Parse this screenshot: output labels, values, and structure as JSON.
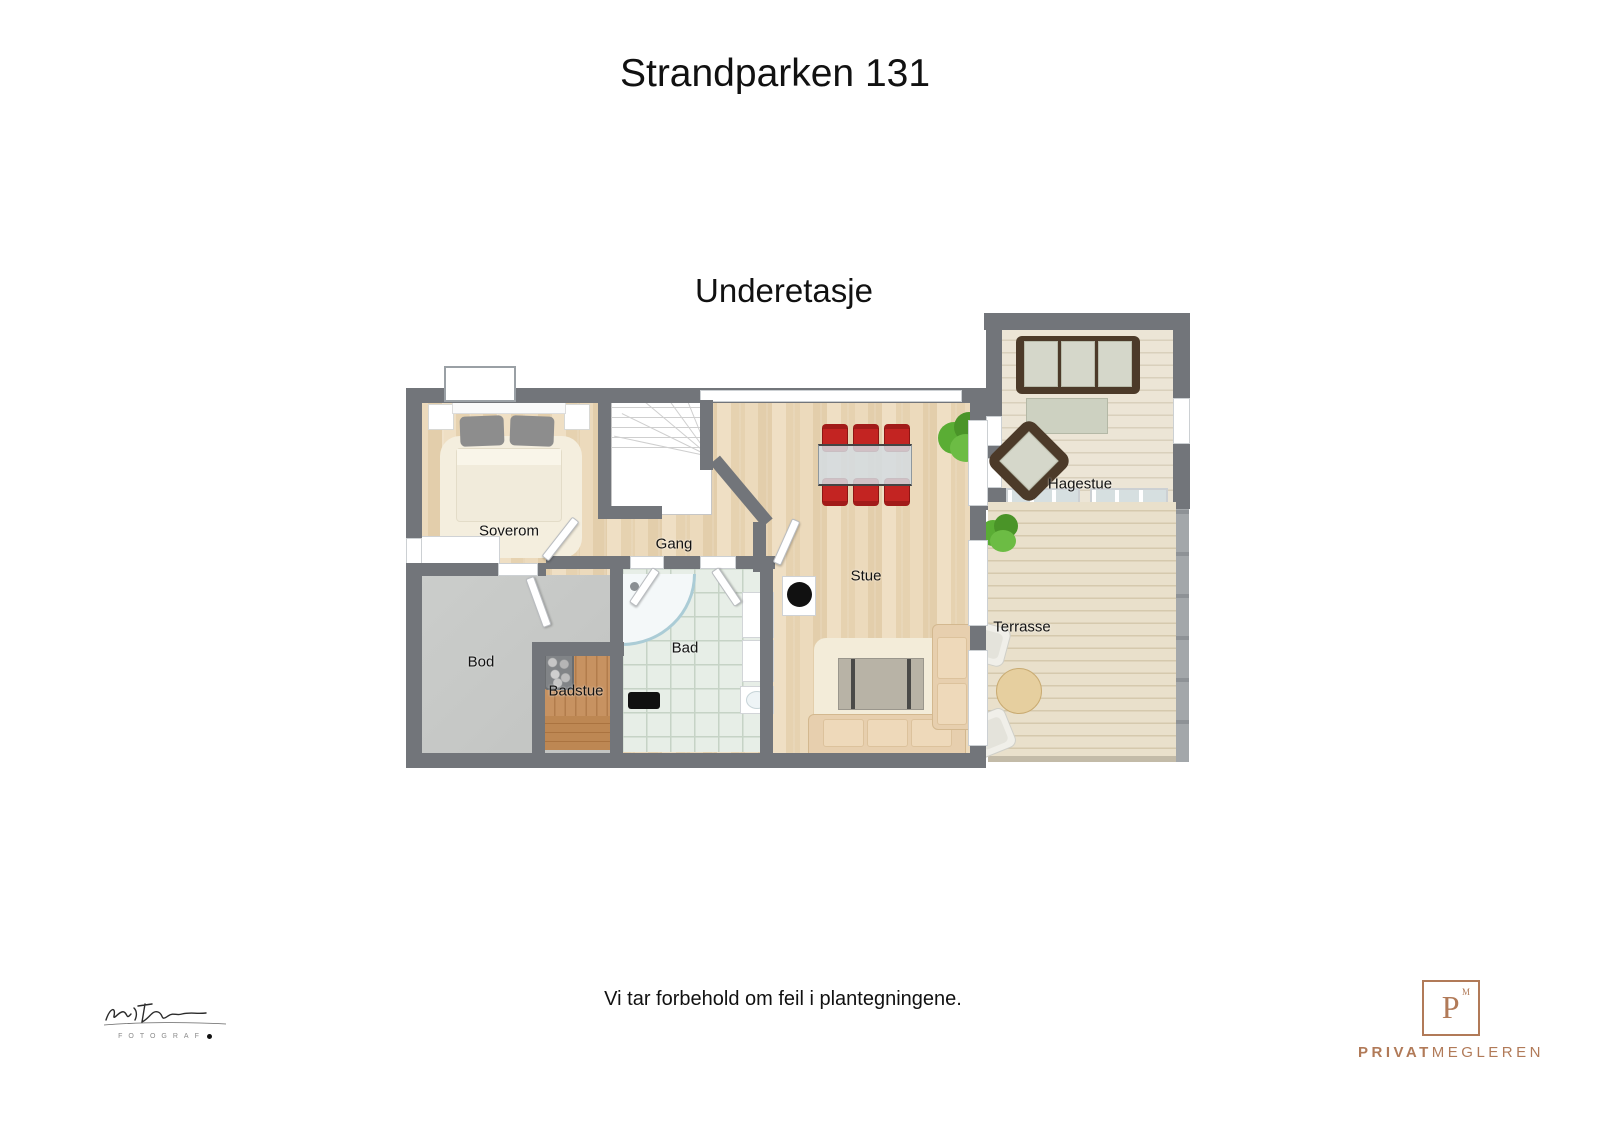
{
  "page": {
    "title": "Strandparken 131",
    "floor_label": "Underetasje",
    "disclaimer": "Vi tar forbehold om feil i plantegningene."
  },
  "floorplan": {
    "rooms": [
      {
        "label": "Soverom"
      },
      {
        "label": "Gang"
      },
      {
        "label": "Stue"
      },
      {
        "label": "Bod"
      },
      {
        "label": "Badstue"
      },
      {
        "label": "Bad"
      },
      {
        "label": "Hagestue"
      },
      {
        "label": "Terrasse"
      }
    ],
    "palette": {
      "wall": "#72757a",
      "wood_floor": "#e6d2b0",
      "whitewash_floor": "#ece5d6",
      "deck_floor": "#e9e0cb",
      "storage_floor": "#c7c9c7",
      "sauna_floor": "#bf8a5c",
      "tile_floor": "#e7eee7",
      "dining_chair_red": "#c32422",
      "sofa_beige": "#e7cfae",
      "wicker_brown": "#4c3a29",
      "plant_green": "#5aad34"
    }
  },
  "footer": {
    "photographer_label": "FOTOGRAF",
    "agency": {
      "symbol": "P",
      "symbol_mark": "M",
      "name_bold": "PRIVAT",
      "name_light": "MEGLEREN",
      "color": "#b17a58"
    }
  }
}
